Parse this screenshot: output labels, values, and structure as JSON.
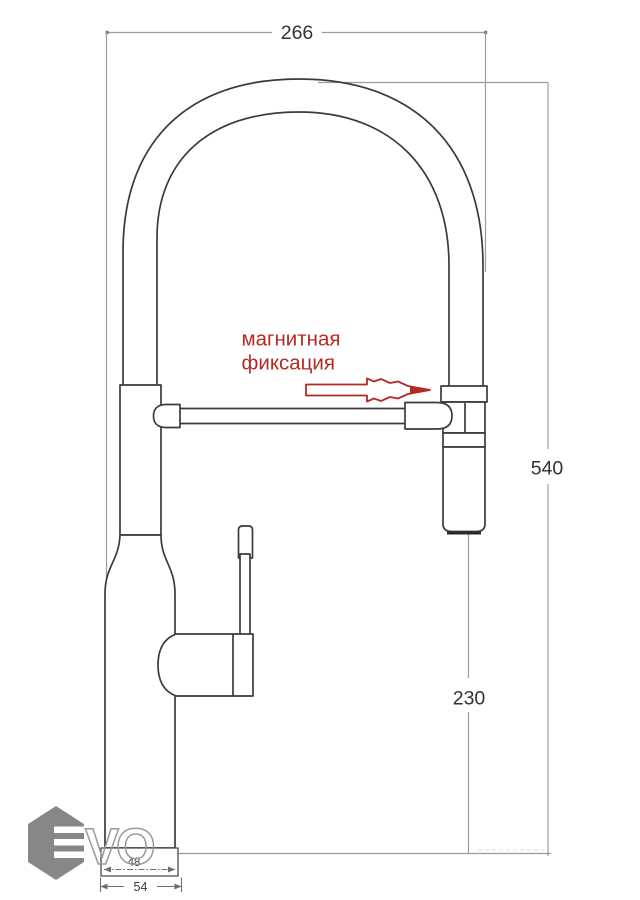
{
  "drawing": {
    "dimensions": {
      "overall_width_mm": "266",
      "overall_height_mm": "540",
      "spray_head_to_base_mm": "230",
      "body_width_mm": "48",
      "flange_width_mm": "54"
    },
    "annotation": {
      "line1": "магнитная",
      "line2": "фиксация"
    },
    "watermark": {
      "letters": "VO"
    },
    "colors": {
      "outline": "#3b3b3b",
      "dimension_lines": "#9c9c9c",
      "annotation_red": "#b42a24",
      "watermark_gray": "#767676",
      "background": "#ffffff"
    }
  }
}
